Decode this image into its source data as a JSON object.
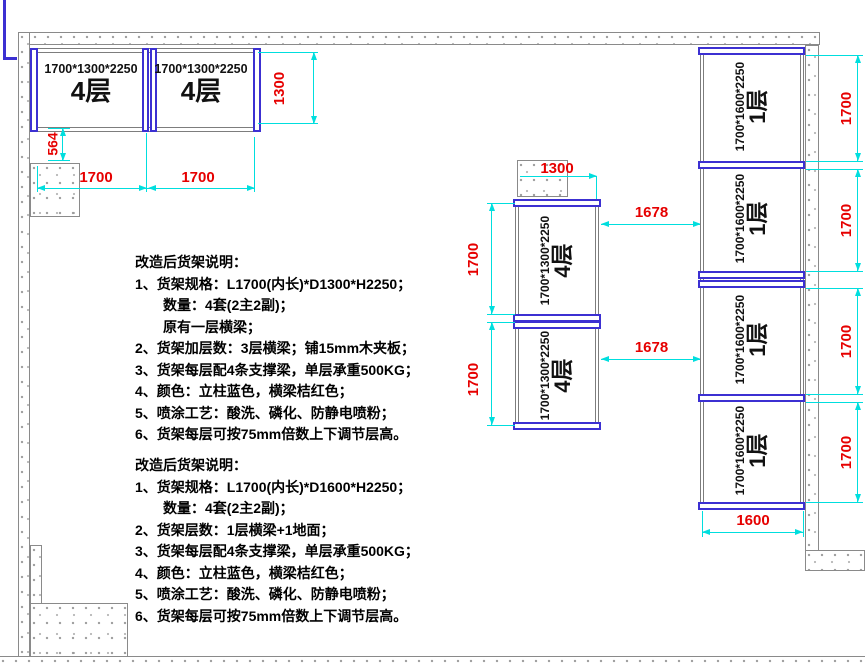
{
  "racks": {
    "top_left": [
      {
        "spec": "1700*1300*2250",
        "layers": "4层"
      },
      {
        "spec": "1700*1300*2250",
        "layers": "4层"
      }
    ],
    "middle": [
      {
        "spec": "1700*1300*2250",
        "layers": "4层"
      },
      {
        "spec": "1700*1300*2250",
        "layers": "4层"
      }
    ],
    "right": [
      {
        "spec": "1700*1600*2250",
        "layers": "1层"
      },
      {
        "spec": "1700*1600*2250",
        "layers": "1层"
      },
      {
        "spec": "1700*1600*2250",
        "layers": "1层"
      },
      {
        "spec": "1700*1600*2250",
        "layers": "1层"
      }
    ]
  },
  "dimensions": {
    "tl_depth": "1300",
    "tl_gap": "564",
    "tl_width_1": "1700",
    "tl_width_2": "1700",
    "mid_col_width": "1300",
    "mid_height_1": "1700",
    "mid_height_2": "1700",
    "aisle_gap_1": "1678",
    "aisle_gap_2": "1678",
    "right_width": "1600",
    "right_height_1": "1700",
    "right_height_2": "1700",
    "right_height_3": "1700",
    "right_height_4": "1700"
  },
  "notes_block_1": {
    "title": "改造后货架说明：",
    "lines": [
      "1、货架规格：L1700(内长)*D1300*H2250；",
      "数量：4套(2主2副)；",
      "原有一层横梁；",
      "2、货架加层数：3层横梁；铺15mm木夹板；",
      "3、货架每层配4条支撑梁，单层承重500KG；",
      "4、颜色：立柱蓝色，横梁桔红色；",
      "5、喷涂工艺：酸洗、磷化、防静电喷粉；",
      "6、货架每层可按75mm倍数上下调节层高。"
    ]
  },
  "notes_block_2": {
    "title": "改造后货架说明：",
    "lines": [
      "1、货架规格：L1700(内长)*D1600*H2250；",
      "数量：4套(2主2副)；",
      "2、货架层数：1层横梁+1地面；",
      "3、货架每层配4条支撑梁，单层承重500KG；",
      "4、颜色：立柱蓝色，横梁桔红色；",
      "5、喷涂工艺：酸洗、磷化、防静电喷粉；",
      "6、货架每层可按75mm倍数上下调节层高。"
    ]
  },
  "colors": {
    "dimension_line": "#00dede",
    "dimension_text": "#e60000",
    "rack_post_blue": "#3c30d2",
    "wall_outline": "#8a8a8a"
  }
}
